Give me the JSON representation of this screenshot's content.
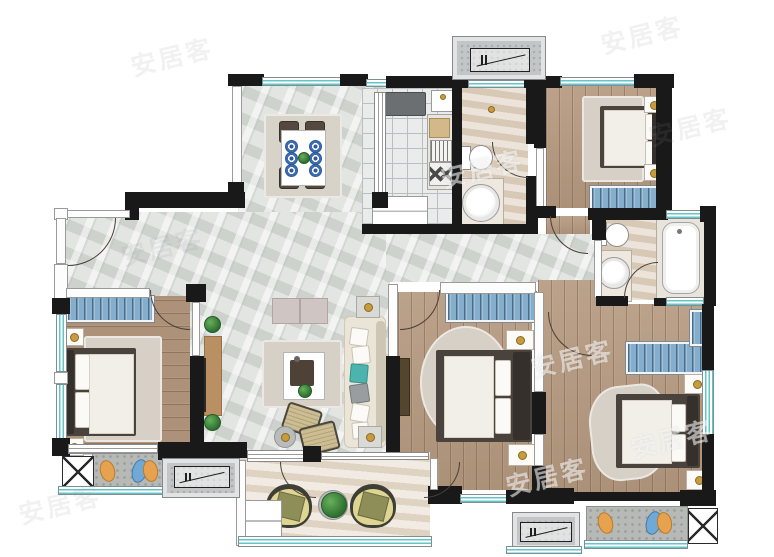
{
  "document": {
    "kind": "residential apartment floor plan rendering",
    "visible_text_language": "Chinese"
  },
  "watermark": {
    "text": "安居客",
    "style": "semi-transparent, rotated, repeated across image",
    "count": 9
  },
  "palette": {
    "wall_black": "#191919",
    "window_teal": "#63c4ca",
    "marble_floor": "#d6dad5",
    "wood_floor": "#b69a80",
    "stone_floor": "#e0d2c1",
    "kitchen_tile": "#eaecec",
    "concrete_gray": "#b7b9b7",
    "wardrobe_blue": "#84aecb",
    "bed_frame": "#4a433d",
    "mattress": "#f2efe8",
    "sofa_cream": "#ebe5d8",
    "accent_teal": "#4db3ad",
    "brass_gold": "#c89b3f",
    "plant_green": "#2f7031",
    "leaf_orange": "#e6a24e",
    "leaf_blue": "#70a9d6"
  },
  "rooms": [
    {
      "id": "dining-room",
      "floor": "marble",
      "contents": [
        "dining-table",
        "4 chairs",
        "6 place-settings",
        "green centerpiece",
        "area rug"
      ]
    },
    {
      "id": "kitchen",
      "floor": "tile",
      "contents": [
        "refrigerator",
        "sink",
        "cutting-board",
        "dish-rack",
        "gas-stove",
        "lower cabinet",
        "sliding glass door"
      ]
    },
    {
      "id": "guest-bathroom",
      "floor": "stone",
      "contents": [
        "toilet",
        "round basin on vanity",
        "swing door"
      ]
    },
    {
      "id": "bedroom-top-right",
      "floor": "wood",
      "contents": [
        "double bed",
        "2 nightstands with lamps",
        "rug",
        "blue wardrobe",
        "window"
      ]
    },
    {
      "id": "master-bathroom",
      "floor": "stone",
      "contents": [
        "toilet",
        "round basin on vanity",
        "bathtub",
        "2 windows",
        "swing door"
      ]
    },
    {
      "id": "living-room",
      "floor": "marble",
      "contents": [
        "cream sofa with pillows",
        "coffee table with tray and plant",
        "tv console",
        "wall tv",
        "2 side tables with lamps",
        "2 ottomans",
        "round side table",
        "sideboard",
        "2 topiary plants"
      ]
    },
    {
      "id": "bedroom-left",
      "floor": "wood",
      "contents": [
        "double bed",
        "2 nightstands with lamps",
        "rug",
        "blue wardrobe",
        "side windows"
      ]
    },
    {
      "id": "bedroom-middle",
      "floor": "wood",
      "contents": [
        "double bed",
        "2 nightstands with lamps",
        "round rug",
        "blue wardrobe",
        "wall tv panel"
      ]
    },
    {
      "id": "master-bedroom",
      "floor": "wood",
      "contents": [
        "double bed",
        "2 nightstands with lamps",
        "rug",
        "blue wardrobe",
        "slim blue cabinet",
        "side window"
      ]
    },
    {
      "id": "south-balcony",
      "floor": "stone",
      "contents": [
        "2 round lounge chairs",
        "potted plant",
        "white cabinet",
        "sliding doors",
        "full-width window"
      ]
    },
    {
      "id": "west-balcony-ledge",
      "floor": "concrete",
      "contents": [
        "orange leaf ornament",
        "blue-orange leaf pair",
        "planter x-box"
      ]
    },
    {
      "id": "southeast-ledge",
      "floor": "concrete",
      "contents": [
        "orange leaf ornament",
        "blue-orange leaf pair",
        "planter x-box"
      ]
    },
    {
      "id": "ac-platforms",
      "count": 3,
      "contents": [
        "air-conditioner outdoor-unit symbol"
      ]
    }
  ],
  "symbols": {
    "door_swing": "quarter-circle arc",
    "window": "teal double line in white frame",
    "ac_unit": "rectangle with two bars and diagonal line",
    "planter": "box with X diagonals"
  }
}
